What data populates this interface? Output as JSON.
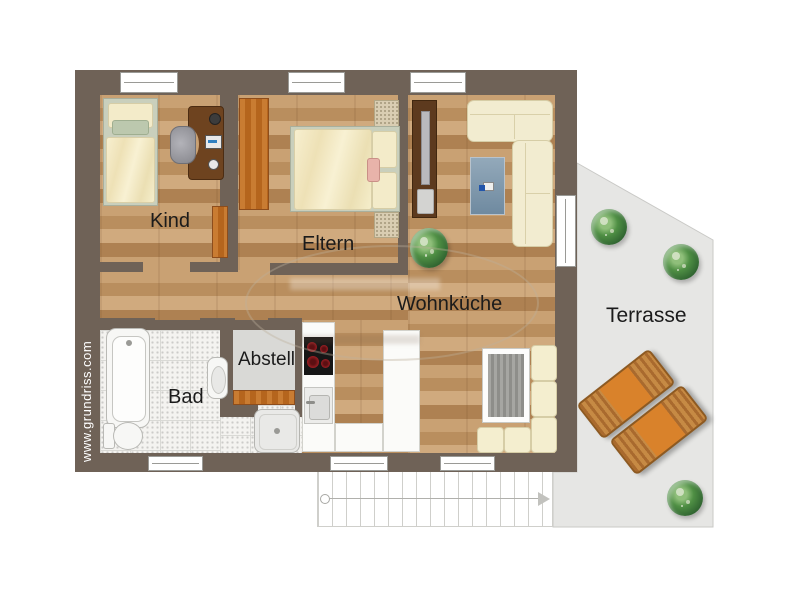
{
  "plan_title": "Apartment floor plan",
  "watermark": {
    "site": "www.grundriss.com"
  },
  "rooms": [
    {
      "id": "kind",
      "label": "Kind"
    },
    {
      "id": "eltern",
      "label": "Eltern"
    },
    {
      "id": "wohnkueche",
      "label": "Wohnküche"
    },
    {
      "id": "bad",
      "label": "Bad"
    },
    {
      "id": "abstell",
      "label": "Abstell"
    },
    {
      "id": "terrasse",
      "label": "Terrasse"
    }
  ],
  "furniture": [
    "single-bed",
    "desk",
    "office-chair",
    "dresser",
    "wardrobe",
    "double-bed",
    "nightstands",
    "tv-board",
    "plant",
    "corner-sofa",
    "rug",
    "kitchen-counter",
    "cooktop",
    "sink",
    "dining-table",
    "corner-bench",
    "bathtub",
    "toilet",
    "washbasin",
    "shower",
    "storage-shelf",
    "sun-loungers",
    "terrace-plants",
    "staircase"
  ],
  "colors": {
    "wall": "#6f6257",
    "wood_floor": "#c9a173",
    "tile_floor": "#f4f3f0",
    "terrace": "#e6e6e4",
    "storage_floor": "#d9d9d6",
    "furniture_orange": "#c97c32",
    "cushion_cream": "#f2ecd0",
    "burner_red": "#9c1e23",
    "plant_green": "#4f8f44",
    "label_text": "#1b1b1b",
    "watermark_text": "#ffffff"
  }
}
